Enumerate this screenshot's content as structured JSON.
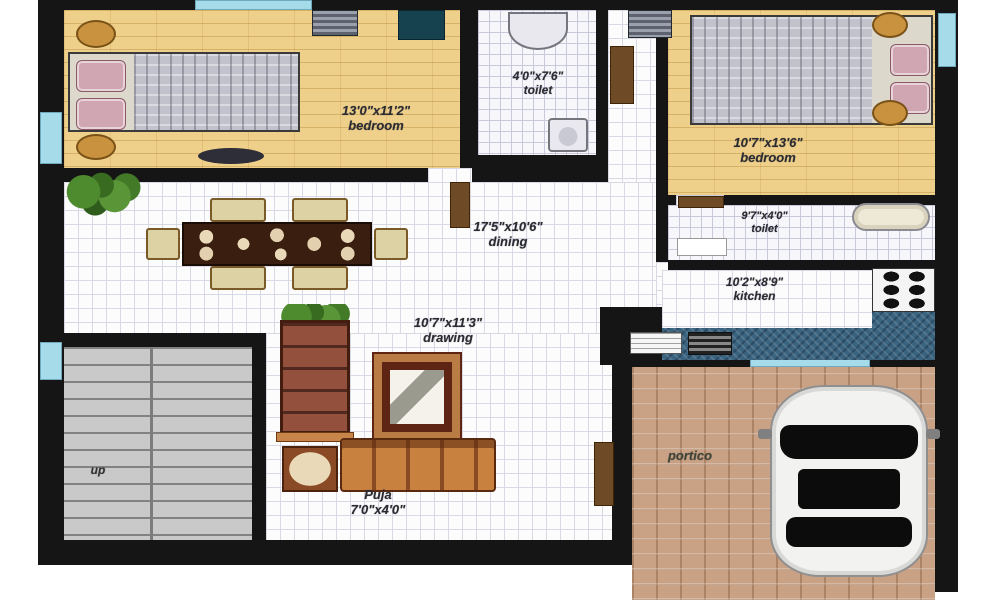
{
  "rooms": {
    "bedroom_top_left": {
      "dims": "13'0\"x11'2\"",
      "name": "bedroom"
    },
    "toilet_top": {
      "dims": "4'0\"x7'6\"",
      "name": "toilet"
    },
    "bedroom_top_right": {
      "dims": "10'7\"x13'6\"",
      "name": "bedroom"
    },
    "dining": {
      "dims": "17'5\"x10'6\"",
      "name": "dining"
    },
    "toilet_right": {
      "dims": "9'7\"x4'0\"",
      "name": "toilet"
    },
    "kitchen": {
      "dims": "10'2\"x8'9\"",
      "name": "kitchen"
    },
    "drawing": {
      "dims": "10'7\"x11'3\"",
      "name": "drawing"
    },
    "puja": {
      "name": "Puja",
      "dims": "7'0\"x4'0\""
    },
    "portico": {
      "name": "portico"
    },
    "staircase": {
      "name": "up"
    }
  },
  "colors": {
    "wall": "#151515",
    "wood_floor": "#efd08a",
    "tile_floor": "#fcfcfd",
    "window": "#a6dbe9",
    "kitchen_counter": "#39637f",
    "portico_floor": "#c9a184",
    "staircase_floor": "#c9c9c9",
    "car_body": "#f2f2f0",
    "door": "#6e4a26"
  }
}
